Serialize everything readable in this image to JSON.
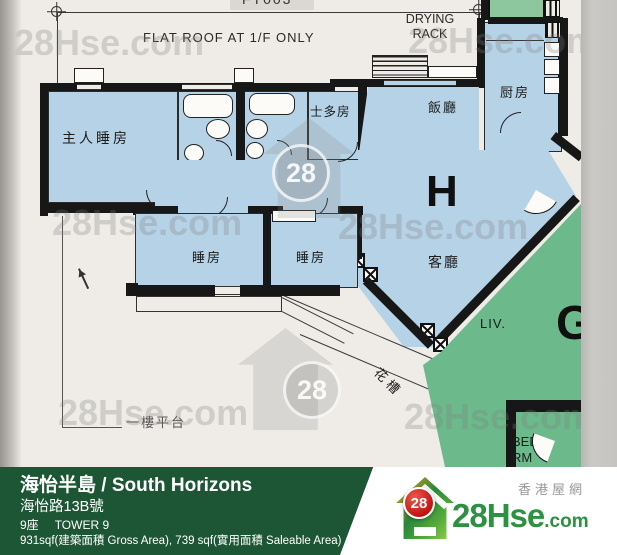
{
  "plan": {
    "code_top": "FT003",
    "flat_roof": "FLAT ROOF AT 1/F ONLY",
    "drying1": "DRYING",
    "drying2": "RACK",
    "master": "主人睡房",
    "store": "士多房",
    "kitchen": "厨房",
    "dining": "飯廳",
    "bed1": "睡房",
    "bed2": "睡房",
    "living": "客廳",
    "unit": "H",
    "planter": "花槽",
    "platform": "一樓平台"
  },
  "adjacent": {
    "living": "LIV.",
    "unit": "G",
    "bed_line1": "BED",
    "bed_line2": "RM"
  },
  "watermark": {
    "text": "28Hse.com",
    "badge": "28"
  },
  "footer": {
    "title": "海怡半島 / South Horizons",
    "address": "海怡路13B號",
    "tower_cn": "9座",
    "tower_en": "TOWER 9",
    "area": "931sqf(建築面積 Gross Area), 739 sqf(實用面積 Saleable Area)"
  },
  "logo": {
    "badge": "28",
    "brand": "28Hse",
    "domain": ".com",
    "tagline": "香港屋網"
  },
  "colors": {
    "room_blue": "#b6d2e6",
    "adjacent_green": "#6cb98b",
    "strip_green": "#8cc79d",
    "bar_green": "#1d5634",
    "wall": "#171717",
    "paper": "#efece7",
    "badge_red": "#bd1414",
    "logo_green": "#2c9140"
  }
}
